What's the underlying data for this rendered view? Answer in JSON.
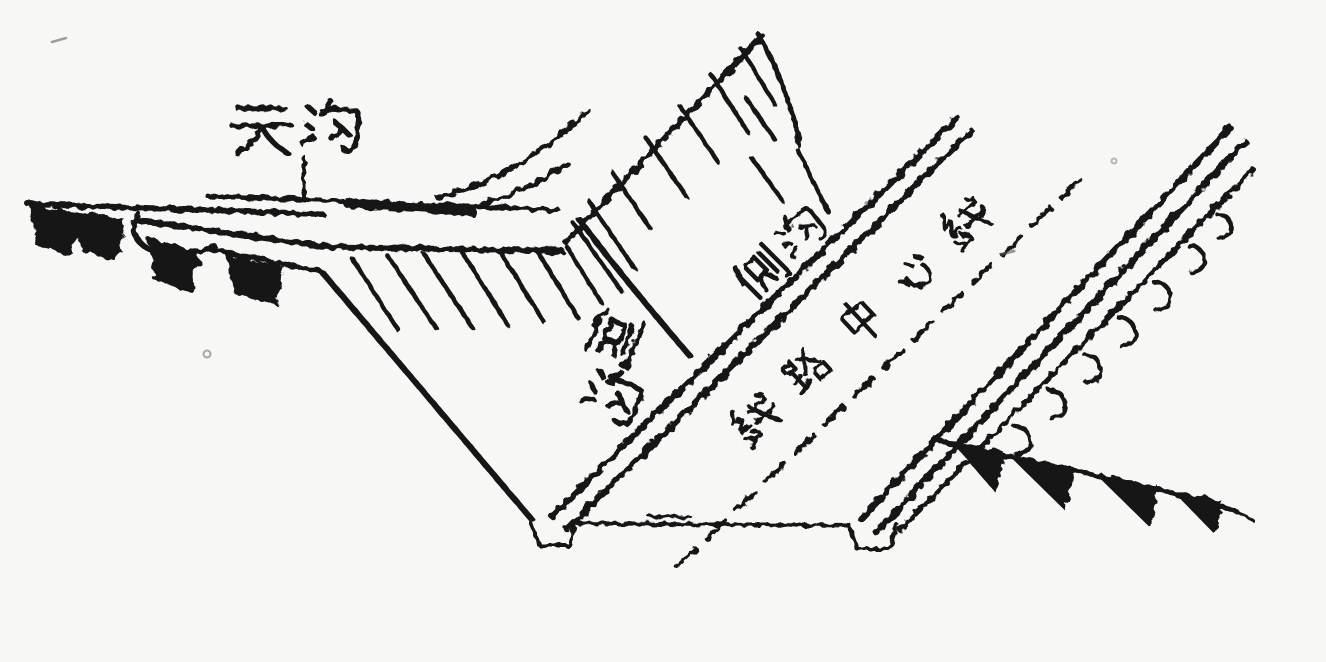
{
  "canvas": {
    "width": 1326,
    "height": 662,
    "background": "#f8f8f6",
    "ink": "#131313",
    "style": "scanned black-and-white engineering line drawing"
  },
  "diagram": {
    "subject": "railway cutting cross-section with drainage ditches (oblique view)",
    "labels": {
      "tiangou": {
        "text": "天沟",
        "orientation": "horizontal"
      },
      "cegou_left": {
        "text": "侧沟",
        "orientation": "tilted-vertical"
      },
      "cegou_right": {
        "text": "侧沟",
        "orientation": "rotated -45°"
      },
      "centerline": {
        "text": "线路中心线",
        "orientation": "rotated -43° along dashed line"
      }
    },
    "line_features": {
      "dashed_centerline": "dashed diagonal line for track center",
      "side_ditch_pairs": "two pairs of parallel diagonal lines",
      "top_ditch": "horizontal double line at upper left with dark water fill",
      "terrain_wedges": "solid black wedge symbols on ground lines",
      "slope_hachures": "short slope tick marks on cut faces"
    }
  }
}
